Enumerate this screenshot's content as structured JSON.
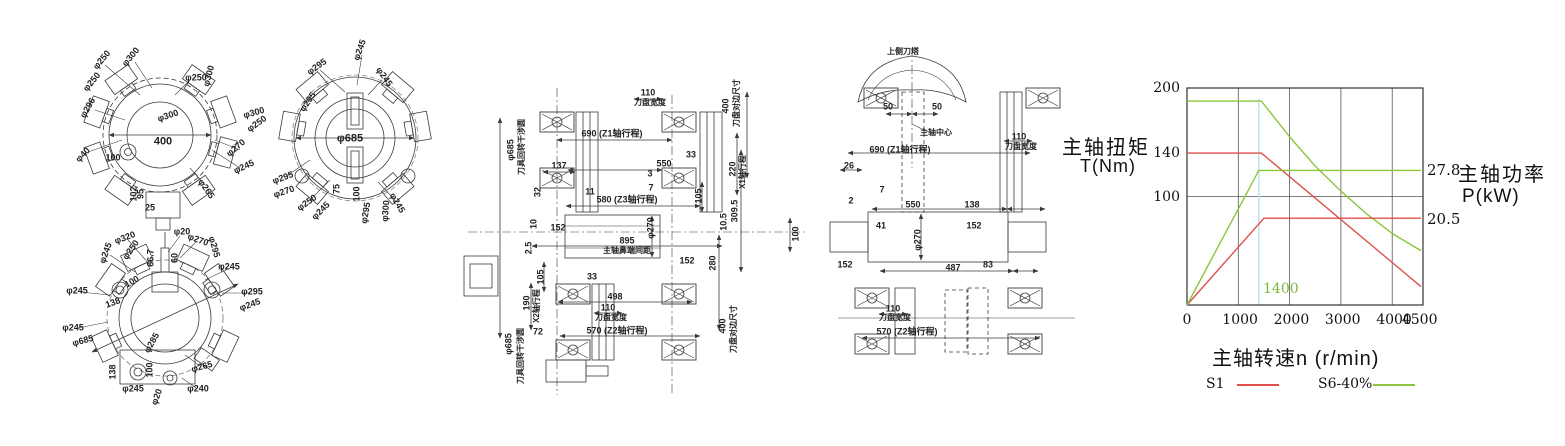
{
  "drawings": {
    "turret_disc_a": {
      "name": "upper turret tool disc front view",
      "labels": [
        {
          "t": "φ250",
          "x": 102,
          "y": 60,
          "r": -50
        },
        {
          "t": "φ300",
          "x": 131,
          "y": 57,
          "r": -50
        },
        {
          "t": "φ250",
          "x": 92,
          "y": 82,
          "r": -50
        },
        {
          "t": "φ296",
          "x": 88,
          "y": 108,
          "r": -60
        },
        {
          "t": "φ250",
          "x": 196,
          "y": 78,
          "r": 0
        },
        {
          "t": "φ300",
          "x": 209,
          "y": 76,
          "r": -75
        },
        {
          "t": "φ300",
          "x": 168,
          "y": 116,
          "r": -18
        },
        {
          "t": "φ300",
          "x": 254,
          "y": 113,
          "r": -15
        },
        {
          "t": "φ250",
          "x": 257,
          "y": 124,
          "r": -35
        },
        {
          "t": "φ270",
          "x": 236,
          "y": 148,
          "r": -40
        },
        {
          "t": "φ245",
          "x": 244,
          "y": 167,
          "r": -25
        },
        {
          "t": "φ265",
          "x": 206,
          "y": 189,
          "r": 55
        },
        {
          "t": "φ40",
          "x": 83,
          "y": 155,
          "r": -45
        },
        {
          "t": "100",
          "x": 113,
          "y": 158,
          "r": 0
        },
        {
          "t": "400",
          "x": 163,
          "y": 142,
          "r": 0,
          "s": 11
        },
        {
          "t": "102",
          "x": 134,
          "y": 194,
          "r": -90
        },
        {
          "t": "95",
          "x": 141,
          "y": 194,
          "r": -90
        },
        {
          "t": "25",
          "x": 150,
          "y": 208,
          "r": 0
        }
      ]
    },
    "turret_disc_b": {
      "name": "turret tool disc front view with interference circle",
      "labels": [
        {
          "t": "φ295",
          "x": 317,
          "y": 67,
          "r": -35
        },
        {
          "t": "φ245",
          "x": 360,
          "y": 50,
          "r": -70
        },
        {
          "t": "φ245",
          "x": 384,
          "y": 77,
          "r": 55
        },
        {
          "t": "φ295",
          "x": 308,
          "y": 102,
          "r": -55
        },
        {
          "t": "φ685",
          "x": 350,
          "y": 139,
          "r": 0,
          "s": 11
        },
        {
          "t": "φ295",
          "x": 283,
          "y": 178,
          "r": -20
        },
        {
          "t": "φ270",
          "x": 284,
          "y": 192,
          "r": -18
        },
        {
          "t": "φ250",
          "x": 307,
          "y": 203,
          "r": -35
        },
        {
          "t": "φ245",
          "x": 321,
          "y": 211,
          "r": -45
        },
        {
          "t": "75",
          "x": 337,
          "y": 189,
          "r": -90
        },
        {
          "t": "100",
          "x": 357,
          "y": 194,
          "r": -90
        },
        {
          "t": "φ295",
          "x": 366,
          "y": 213,
          "r": -80
        },
        {
          "t": "φ300",
          "x": 386,
          "y": 211,
          "r": -85
        },
        {
          "t": "φ245",
          "x": 397,
          "y": 203,
          "r": 60
        }
      ]
    },
    "turret_disc_c": {
      "name": "lower turret tool disc front view",
      "labels": [
        {
          "t": "φ320",
          "x": 125,
          "y": 238,
          "r": -20
        },
        {
          "t": "φ20",
          "x": 182,
          "y": 232,
          "r": 0
        },
        {
          "t": "φ270",
          "x": 198,
          "y": 240,
          "r": 20
        },
        {
          "t": "φ250",
          "x": 131,
          "y": 250,
          "r": -55
        },
        {
          "t": "φ245",
          "x": 106,
          "y": 253,
          "r": -70
        },
        {
          "t": "φ295",
          "x": 214,
          "y": 247,
          "r": 75
        },
        {
          "t": "φ245",
          "x": 229,
          "y": 267,
          "r": 0
        },
        {
          "t": "66.7",
          "x": 151,
          "y": 258,
          "r": -90
        },
        {
          "t": "60",
          "x": 175,
          "y": 258,
          "r": -90
        },
        {
          "t": "100",
          "x": 132,
          "y": 282,
          "r": -30
        },
        {
          "t": "138",
          "x": 113,
          "y": 303,
          "r": -20
        },
        {
          "t": "φ245",
          "x": 77,
          "y": 291,
          "r": 0
        },
        {
          "t": "φ295",
          "x": 252,
          "y": 292,
          "r": 0
        },
        {
          "t": "φ245",
          "x": 250,
          "y": 305,
          "r": -20
        },
        {
          "t": "φ245",
          "x": 73,
          "y": 328,
          "r": 0
        },
        {
          "t": "φ685",
          "x": 83,
          "y": 341,
          "r": -15
        },
        {
          "t": "φ285",
          "x": 152,
          "y": 343,
          "r": -60
        },
        {
          "t": "φ265",
          "x": 202,
          "y": 367,
          "r": -15
        },
        {
          "t": "138",
          "x": 113,
          "y": 372,
          "r": -90
        },
        {
          "t": "100",
          "x": 150,
          "y": 370,
          "r": -90
        },
        {
          "t": "φ245",
          "x": 133,
          "y": 389,
          "r": 0
        },
        {
          "t": "φ20",
          "x": 157,
          "y": 397,
          "r": -70
        },
        {
          "t": "φ240",
          "x": 198,
          "y": 389,
          "r": 0
        }
      ]
    },
    "side_view_main": {
      "name": "turret/spindle side view with travel dimensions",
      "labels": [
        {
          "t": "φ685",
          "x": 511,
          "y": 150,
          "r": -90
        },
        {
          "t": "刀具回转干涉圆",
          "x": 522,
          "y": 147,
          "r": -90,
          "s": 8
        },
        {
          "t": "110",
          "x": 648,
          "y": 93,
          "r": 0
        },
        {
          "t": "刀盘宽度",
          "x": 650,
          "y": 103,
          "r": 0,
          "s": 8
        },
        {
          "t": "400",
          "x": 726,
          "y": 106,
          "r": -90
        },
        {
          "t": "刀盘对边尺寸",
          "x": 737,
          "y": 103,
          "r": -90,
          "s": 8
        },
        {
          "t": "690 (Z1轴行程)",
          "x": 612,
          "y": 134,
          "r": 0
        },
        {
          "t": "137",
          "x": 559,
          "y": 166,
          "r": 0
        },
        {
          "t": "550",
          "x": 664,
          "y": 164,
          "r": 0
        },
        {
          "t": "33",
          "x": 691,
          "y": 155,
          "r": 0
        },
        {
          "t": "220",
          "x": 733,
          "y": 169,
          "r": -90
        },
        {
          "t": "X1轴行程",
          "x": 743,
          "y": 172,
          "r": -90,
          "s": 8
        },
        {
          "t": "3",
          "x": 650,
          "y": 174,
          "r": 0
        },
        {
          "t": "7",
          "x": 651,
          "y": 188,
          "r": 0
        },
        {
          "t": "32",
          "x": 538,
          "y": 192,
          "r": -90
        },
        {
          "t": "11",
          "x": 590,
          "y": 192,
          "r": 0
        },
        {
          "t": "580 (Z3轴行程)",
          "x": 627,
          "y": 200,
          "r": 0
        },
        {
          "t": "105",
          "x": 699,
          "y": 196,
          "r": -90
        },
        {
          "t": "309.5",
          "x": 735,
          "y": 211,
          "r": -90
        },
        {
          "t": "10.5",
          "x": 724,
          "y": 222,
          "r": -90
        },
        {
          "t": "10",
          "x": 534,
          "y": 224,
          "r": -90
        },
        {
          "t": "152",
          "x": 558,
          "y": 228,
          "r": 0
        },
        {
          "t": "φ270",
          "x": 651,
          "y": 228,
          "r": -90
        },
        {
          "t": "895",
          "x": 627,
          "y": 241,
          "r": 0
        },
        {
          "t": "主轴鼻端间距",
          "x": 627,
          "y": 251,
          "r": 0,
          "s": 8
        },
        {
          "t": "2.5",
          "x": 529,
          "y": 248,
          "r": -90
        },
        {
          "t": "152",
          "x": 687,
          "y": 261,
          "r": 0
        },
        {
          "t": "280",
          "x": 713,
          "y": 263,
          "r": -90
        },
        {
          "t": "100",
          "x": 796,
          "y": 234,
          "r": -90
        },
        {
          "t": "105",
          "x": 541,
          "y": 277,
          "r": -90
        },
        {
          "t": "33",
          "x": 592,
          "y": 277,
          "r": 0
        },
        {
          "t": "498",
          "x": 615,
          "y": 297,
          "r": 0
        },
        {
          "t": "110",
          "x": 608,
          "y": 308,
          "r": 0
        },
        {
          "t": "刀盘宽度",
          "x": 611,
          "y": 318,
          "r": 0,
          "s": 8
        },
        {
          "t": "570 (Z2轴行程)",
          "x": 617,
          "y": 331,
          "r": 0
        },
        {
          "t": "72",
          "x": 538,
          "y": 332,
          "r": 0
        },
        {
          "t": "190",
          "x": 527,
          "y": 303,
          "r": -90
        },
        {
          "t": "X2轴行程",
          "x": 537,
          "y": 306,
          "r": -90,
          "s": 8
        },
        {
          "t": "φ685",
          "x": 509,
          "y": 344,
          "r": -90
        },
        {
          "t": "刀具回转干涉圆",
          "x": 521,
          "y": 356,
          "r": -90,
          "s": 8
        },
        {
          "t": "400",
          "x": 723,
          "y": 326,
          "r": -90
        },
        {
          "t": "刀盘对边尺寸",
          "x": 734,
          "y": 329,
          "r": -90,
          "s": 8
        }
      ]
    },
    "side_view_upper": {
      "name": "upper turret / spindle-center side view",
      "labels": [
        {
          "t": "上侧刀塔",
          "x": 903,
          "y": 52,
          "r": 0,
          "s": 8
        },
        {
          "t": "50",
          "x": 888,
          "y": 107,
          "r": 0
        },
        {
          "t": "50",
          "x": 937,
          "y": 107,
          "r": 0
        },
        {
          "t": "主轴中心",
          "x": 936,
          "y": 133,
          "r": 0,
          "s": 8
        },
        {
          "t": "110",
          "x": 1019,
          "y": 137,
          "r": 0
        },
        {
          "t": "刀盘宽度",
          "x": 1021,
          "y": 147,
          "r": 0,
          "s": 8
        },
        {
          "t": "690 (Z1轴行程)",
          "x": 900,
          "y": 150,
          "r": 0
        },
        {
          "t": "26",
          "x": 849,
          "y": 166,
          "r": 0
        },
        {
          "t": "7",
          "x": 882,
          "y": 190,
          "r": 0
        },
        {
          "t": "2",
          "x": 851,
          "y": 201,
          "r": 0
        },
        {
          "t": "550",
          "x": 913,
          "y": 205,
          "r": 0
        },
        {
          "t": "138",
          "x": 972,
          "y": 205,
          "r": 0
        },
        {
          "t": "41",
          "x": 881,
          "y": 226,
          "r": 0
        },
        {
          "t": "φ270",
          "x": 918,
          "y": 240,
          "r": -90
        },
        {
          "t": "152",
          "x": 974,
          "y": 226,
          "r": 0
        },
        {
          "t": "152",
          "x": 845,
          "y": 265,
          "r": 0
        },
        {
          "t": "487",
          "x": 953,
          "y": 268,
          "r": 0
        },
        {
          "t": "83",
          "x": 988,
          "y": 265,
          "r": 0
        },
        {
          "t": "110",
          "x": 893,
          "y": 309,
          "r": 0
        },
        {
          "t": "刀盘宽度",
          "x": 895,
          "y": 318,
          "r": 0,
          "s": 8
        },
        {
          "t": "570 (Z2轴行程)",
          "x": 907,
          "y": 332,
          "r": 0
        }
      ]
    }
  },
  "chart_data": {
    "type": "line",
    "ylabel_left_line1": "主轴扭矩",
    "ylabel_left_line2": "T(Nm)",
    "ylabel_right_line1": "主轴功率",
    "ylabel_right_line2": "P(kW)",
    "annotation_power_s6": "27.8",
    "annotation_power_s1": "20.5",
    "annotation_base_speed": "1400",
    "xlabel": "主轴转速n (r/min)",
    "x_ticks": [
      0,
      1000,
      2000,
      3000,
      4000,
      4500
    ],
    "y_ticks": [
      100,
      140,
      200
    ],
    "xlim": [
      0,
      4600
    ],
    "ylim": [
      0,
      200
    ],
    "grid_x": [
      1000,
      2000,
      3000,
      4000
    ],
    "grid_y": [
      100
    ],
    "base_speed_line_x": 1400,
    "colors": {
      "s1": "#e0504b",
      "s6": "#8cc63f",
      "base_line": "#bfe3f2",
      "grid": "#555",
      "frame": "#333"
    },
    "legend": [
      {
        "label": "S1",
        "color": "#e0504b"
      },
      {
        "label": "S6-40%",
        "color": "#8cc63f"
      }
    ],
    "series": [
      {
        "name": "S1 torque (Nm)",
        "color": "#e0504b",
        "points": [
          [
            0,
            140
          ],
          [
            1450,
            140
          ],
          [
            4560,
            17
          ]
        ]
      },
      {
        "name": "S6-40% torque (Nm)",
        "color": "#8cc63f",
        "points": [
          [
            0,
            188
          ],
          [
            1450,
            188
          ],
          [
            2000,
            155
          ],
          [
            2500,
            128
          ],
          [
            3000,
            105
          ],
          [
            3500,
            84
          ],
          [
            4000,
            66
          ],
          [
            4560,
            50
          ]
        ]
      },
      {
        "name": "S1 power (20.5 kW, left-axis units)",
        "color": "#e0504b",
        "points": [
          [
            0,
            0
          ],
          [
            1500,
            80
          ],
          [
            4560,
            80
          ]
        ]
      },
      {
        "name": "S6-40% power (27.8 kW, left-axis units)",
        "color": "#8cc63f",
        "points": [
          [
            0,
            0
          ],
          [
            1400,
            124
          ],
          [
            4560,
            124
          ]
        ]
      }
    ]
  }
}
